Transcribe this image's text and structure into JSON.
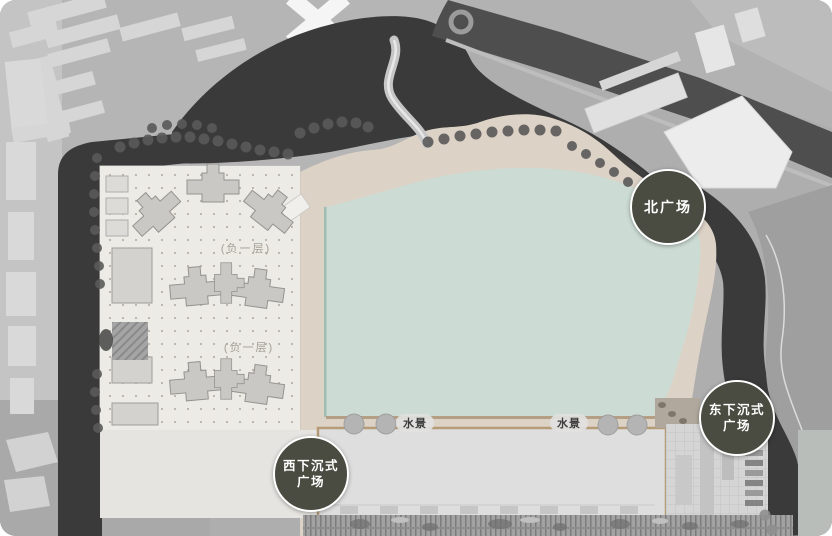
{
  "plan": {
    "badges": {
      "north": {
        "text": "北广场"
      },
      "east": {
        "line1": "东下沉式",
        "line2": "广场"
      },
      "west": {
        "line1": "西下沉式",
        "line2": "广场"
      }
    },
    "water_labels": {
      "left": "水景",
      "right": "水景"
    },
    "basement_labels": {
      "upper": "(负一层)",
      "lower": "(负一层)"
    }
  },
  "colors": {
    "water_green": "#ccdcd4",
    "plaza_beige": "#ddd2c6",
    "badge_bg": "#4a4c41",
    "badge_border": "#ffffff",
    "badge_text": "#ffffff",
    "road_dark": "#3a3a3a",
    "label_text": "#3c3c3c"
  }
}
